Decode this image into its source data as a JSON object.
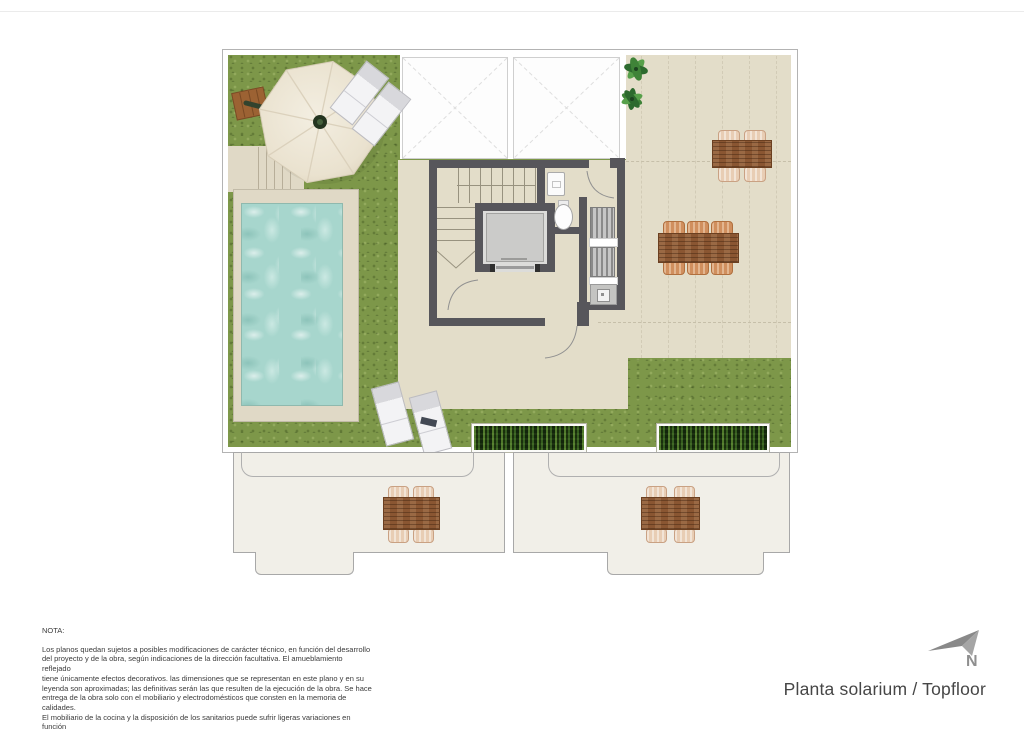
{
  "note": {
    "title": "NOTA:",
    "lines": [
      "Los planos quedan sujetos a posibles modificaciones de carácter técnico, en función del desarrollo",
      "del proyecto y de la obra, según indicaciones de la dirección facultativa. El amueblamiento reflejado",
      "tiene únicamente efectos decorativos. las dimensiones que se representan en este plano y en su",
      "leyenda son aproximadas; las definitivas serán las que resulten de la ejecución de la obra. Se hace",
      "entrega de la obra solo con el mobiliario y electrodomésticos que consten en la memoria de calidades.",
      "El mobiliario de la cocina y la disposición de los sanitarios puede sufrir ligeras variaciones en función",
      "del montaje definitivo."
    ]
  },
  "title_block": {
    "text": "Planta solarium / Topfloor"
  },
  "compass": {
    "label": "N"
  },
  "symbols": [
    "parasol-umbrella",
    "sun-lounger",
    "swimming-pool",
    "staircase",
    "elevator",
    "toilet",
    "barbecue-appliances",
    "sink",
    "dining-table",
    "chair",
    "planter",
    "plant",
    "skylight",
    "north-arrow"
  ],
  "palette": {
    "grass": "#7d9749",
    "terrace": "#e3ddc9",
    "deck": "#e0d9c6",
    "pool_water": "#a7d6cd",
    "wall": "#57565b",
    "wood": "#8a5632",
    "chair_light": "#e8cdb4",
    "chair_mid": "#d08f5e",
    "planter_green": "#223c15",
    "lower_terrace": "#f1efe8",
    "outline_gray": "#b3b3b3",
    "text": "#3b3b3b",
    "compass_gray": "#8f8f8f"
  }
}
